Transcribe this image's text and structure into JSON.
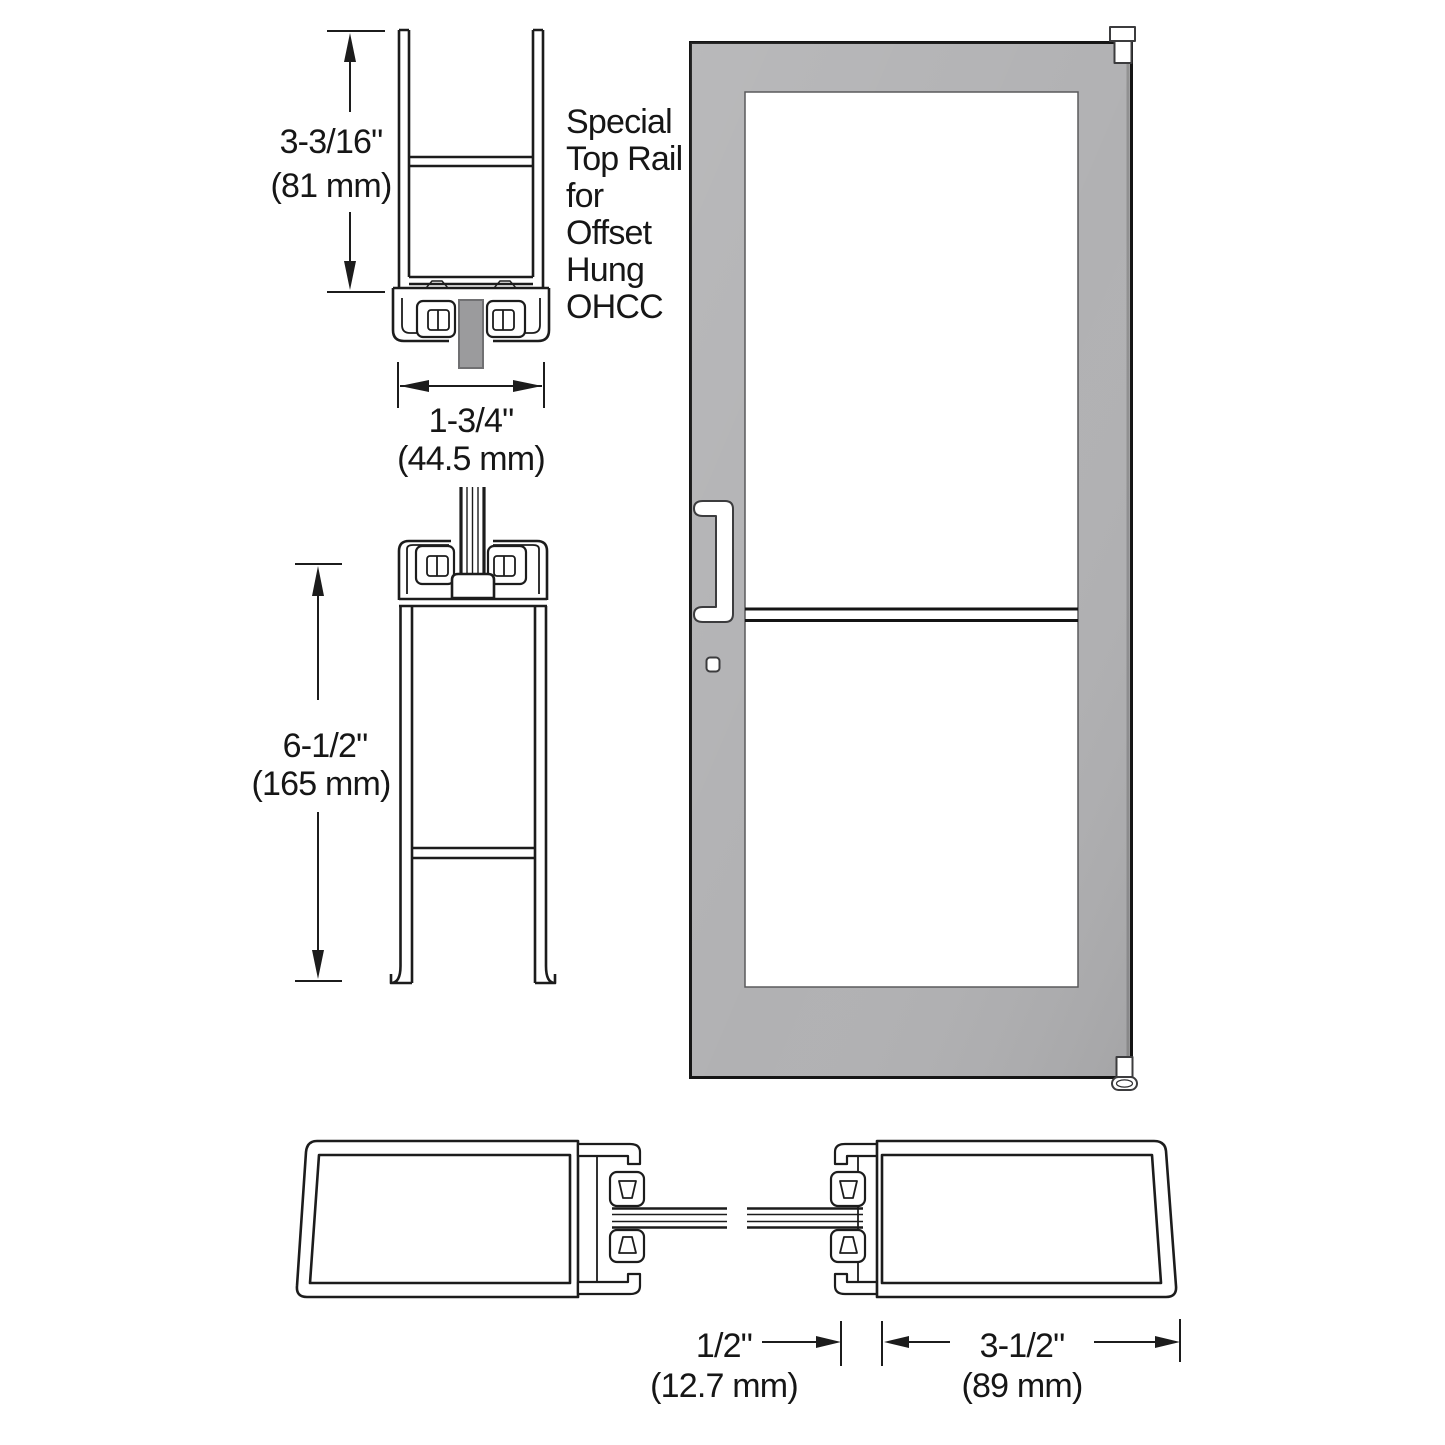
{
  "diagram_title": "Special Top Rail for Offset Hung OHCC door - dimension drawing",
  "note": {
    "lines": [
      "Special",
      "Top Rail",
      "for",
      "Offset",
      "Hung",
      "OHCC"
    ]
  },
  "dims": {
    "top_rail_height": {
      "inches": "3-3/16\"",
      "metric": "(81 mm)"
    },
    "top_rail_width": {
      "inches": "1-3/4\"",
      "metric": "(44.5 mm)"
    },
    "bottom_rail_height": {
      "inches": "6-1/2\"",
      "metric": "(165 mm)"
    },
    "glass_stop": {
      "inches": "1/2\"",
      "metric": "(12.7 mm)"
    },
    "stile_width": {
      "inches": "3-1/2\"",
      "metric": "(89 mm)"
    }
  },
  "colors": {
    "line": "#1c1c1c",
    "door_gray": "#b1b1b3",
    "glass_stub_gray": "#9b9b9d",
    "glass_white": "#ffffff",
    "background": "#ffffff"
  }
}
